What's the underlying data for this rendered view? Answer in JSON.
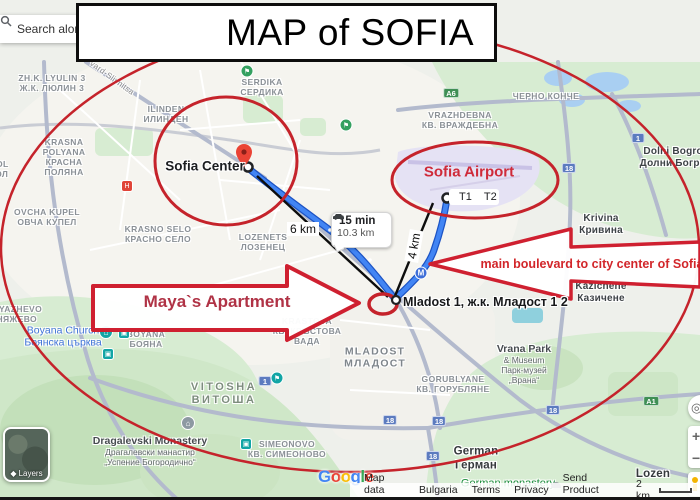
{
  "title": {
    "text": "MAP of SOFIA"
  },
  "search": {
    "placeholder": "Search along"
  },
  "annotations": {
    "center_label": "Sofia Center",
    "airport_label": "Sofia Airport",
    "terminal1": "T1",
    "terminal2": "T2",
    "route_time": "15 min",
    "route_distance": "10.3 km",
    "dist_center_line": "6 km",
    "dist_airport_line": "4 km",
    "apartment_arrow_text": "Maya`s Apartment",
    "boulevard_arrow_text": "main boulevard to city center of Sofia",
    "mladost_marker_label": "Mladost 1, ж.к. Младост 1 2",
    "metro_icon_glyph": "M"
  },
  "colors": {
    "annotation_red": "#c5232b",
    "arrow_stroke_red": "#cf2030",
    "maya_text_red": "#b03346",
    "boulevard_text_red": "#d2262a",
    "route_blue": "#4285f4",
    "route_blue_dark": "#1c53c4",
    "google": [
      "#4285F4",
      "#EA4335",
      "#FBBC05",
      "#4285F4",
      "#34A853",
      "#EA4335"
    ]
  },
  "map_labels": [
    {
      "name": "lyulin",
      "cls": "district",
      "x": 52,
      "y": 83,
      "lines": [
        "ZH.K. LYULIN 3",
        "Ж.К. ЛЮЛИН 3"
      ]
    },
    {
      "name": "slivnitsa-road",
      "cls": "road",
      "x": 112,
      "y": 78,
      "rotate": 36,
      "lines": [
        "vard-Slivnitsa"
      ]
    },
    {
      "name": "serdika",
      "cls": "district",
      "x": 262,
      "y": 87,
      "lines": [
        "SERDIKA",
        "СЕРДИКА"
      ]
    },
    {
      "name": "ilinden",
      "cls": "district",
      "x": 166,
      "y": 114,
      "lines": [
        "ILINDEN",
        "ИЛИНДЕН"
      ]
    },
    {
      "name": "cherno-konche",
      "cls": "district",
      "x": 546,
      "y": 96,
      "lines": [
        "ЧЕРНО КОНЧЕ"
      ]
    },
    {
      "name": "vrazhdebna",
      "cls": "district",
      "x": 460,
      "y": 120,
      "lines": [
        "VRAZHDEBNA",
        "КВ. ВРАЖДЕБНА"
      ]
    },
    {
      "name": "dolni-bogrov",
      "cls": "town",
      "x": 676,
      "y": 158,
      "lines": [
        "Dolni Bogrov",
        "Долни Богров"
      ]
    },
    {
      "name": "krivina",
      "cls": "town",
      "x": 601,
      "y": 225,
      "lines": [
        "Krivina",
        "Кривина"
      ]
    },
    {
      "name": "kazichene",
      "cls": "town",
      "x": 601,
      "y": 293,
      "lines": [
        "Kazichene",
        "Казичене"
      ]
    },
    {
      "name": "suhodol",
      "cls": "district",
      "x": -14,
      "y": 169,
      "lines": [
        "SUHODOL",
        "СУХОДОЛ"
      ]
    },
    {
      "name": "krasna-polyana",
      "cls": "district",
      "x": 64,
      "y": 157,
      "lines": [
        "KRASNA",
        "POLYANA",
        "КРАСНА",
        "ПОЛЯНА"
      ]
    },
    {
      "name": "ovcha-kupel",
      "cls": "district",
      "x": 47,
      "y": 217,
      "lines": [
        "OVCHA KUPEL",
        "ОВЧА КУПЕЛ"
      ]
    },
    {
      "name": "krasno-selo",
      "cls": "district",
      "x": 158,
      "y": 234,
      "lines": [
        "KRASNO SELO",
        "КРАСНО СЕЛО"
      ]
    },
    {
      "name": "lozenets",
      "cls": "district",
      "x": 263,
      "y": 242,
      "lines": [
        "LOZENETS",
        "ЛОЗЕНЕЦ"
      ]
    },
    {
      "name": "krastova-vada",
      "cls": "district",
      "x": 307,
      "y": 331,
      "lines": [
        "KRASTOVA",
        "КВ. КРЪСТОВА",
        "ВАДА"
      ]
    },
    {
      "name": "boyana-church",
      "cls": "poi-blue",
      "x": 63,
      "y": 337,
      "lines": [
        "Boyana Church",
        "Боянска църква"
      ]
    },
    {
      "name": "boyana",
      "cls": "district",
      "x": 146,
      "y": 339,
      "lines": [
        "BOYANA",
        "БОЯНА"
      ]
    },
    {
      "name": "knyazhevo",
      "cls": "district",
      "x": 14,
      "y": 314,
      "lines": [
        "KNYAZHEVO",
        "КНЯЖЕВО"
      ]
    },
    {
      "name": "vitosha",
      "cls": "mountain",
      "x": 224,
      "y": 394,
      "lines": [
        "VITOSHA",
        "ВИТОША"
      ]
    },
    {
      "name": "dragalevski-monastery",
      "cls": "poi-dark",
      "x": 150,
      "y": 451,
      "lines": [
        "Dragalevski Monastery",
        "Драгалевски манастир",
        "„Успение Богородично“"
      ]
    },
    {
      "name": "simeonovo",
      "cls": "district",
      "x": 287,
      "y": 449,
      "lines": [
        "SIMEONOVO",
        "КВ. СИМЕОНОВО"
      ]
    },
    {
      "name": "mladost",
      "cls": "district-lg",
      "x": 375,
      "y": 358,
      "lines": [
        "MLADOST",
        "МЛАДОСТ"
      ]
    },
    {
      "name": "gorublyane",
      "cls": "district",
      "x": 453,
      "y": 384,
      "lines": [
        "GORUBLYANE",
        "КВ. ГОРУБЛЯНЕ"
      ]
    },
    {
      "name": "vrana-park",
      "cls": "poi-dark",
      "x": 524,
      "y": 364,
      "lines": [
        "Vrana Park",
        "& Museum",
        "Парк-музей",
        "„Врана“"
      ]
    },
    {
      "name": "german",
      "cls": "town-lg",
      "x": 476,
      "y": 459,
      "lines": [
        "German",
        "Герман"
      ]
    },
    {
      "name": "german-monastery",
      "cls": "poi-green",
      "x": 508,
      "y": 484,
      "lines": [
        "German monastery"
      ]
    },
    {
      "name": "lozen",
      "cls": "town-lg",
      "x": 653,
      "y": 475,
      "lines": [
        "Lozen"
      ]
    }
  ],
  "road_shields": [
    {
      "label": "A6",
      "kind": "g",
      "x": 451,
      "y": 93
    },
    {
      "label": "1",
      "kind": "b",
      "x": 638,
      "y": 138
    },
    {
      "label": "18",
      "kind": "b",
      "x": 569,
      "y": 168
    },
    {
      "label": "1",
      "kind": "b",
      "x": 265,
      "y": 381
    },
    {
      "label": "18",
      "kind": "b",
      "x": 390,
      "y": 420
    },
    {
      "label": "18",
      "kind": "b",
      "x": 439,
      "y": 421
    },
    {
      "label": "18",
      "kind": "b",
      "x": 553,
      "y": 410
    },
    {
      "label": "A1",
      "kind": "g",
      "x": 651,
      "y": 401
    },
    {
      "label": "18",
      "kind": "b",
      "x": 433,
      "y": 456
    }
  ],
  "poi_icons": [
    {
      "name": "park-poi-icon",
      "shape": "circle",
      "color": "#34a060",
      "glyph": "⚑",
      "x": 247,
      "y": 71
    },
    {
      "name": "park-poi-icon",
      "shape": "circle",
      "color": "#34a060",
      "glyph": "⚑",
      "x": 346,
      "y": 125
    },
    {
      "name": "hospital-icon",
      "shape": "square",
      "color": "#e04438",
      "glyph": "H",
      "x": 127,
      "y": 186
    },
    {
      "name": "church-pin-icon",
      "shape": "pin",
      "color": "#12a5a5",
      "glyph": "⌂",
      "x": 106,
      "y": 332
    },
    {
      "name": "museum-poi-icon",
      "shape": "square",
      "color": "#12a5a5",
      "glyph": "▣",
      "x": 124,
      "y": 333
    },
    {
      "name": "museum-poi-icon",
      "shape": "square",
      "color": "#12a5a5",
      "glyph": "▣",
      "x": 108,
      "y": 354
    },
    {
      "name": "monastery-pin-icon",
      "shape": "pin",
      "color": "#8d99a2",
      "glyph": "⌂",
      "x": 188,
      "y": 423
    },
    {
      "name": "museum-poi-icon",
      "shape": "square",
      "color": "#12a5a5",
      "glyph": "▣",
      "x": 246,
      "y": 444
    },
    {
      "name": "park-poi-icon",
      "shape": "circle",
      "color": "#12a5a5",
      "glyph": "⚑",
      "x": 277,
      "y": 378
    },
    {
      "name": "monastery-dome-icon",
      "shape": "dome",
      "color": "#9aa0a6",
      "glyph": "",
      "x": 556,
      "y": 485
    }
  ],
  "controls": {
    "layers_label": "Layers",
    "zoom_in": "+",
    "zoom_out": "−",
    "my_location_glyph": "◎"
  },
  "footer": {
    "logo": "Google",
    "map_data": "Map data ©2024",
    "links": [
      "Bulgaria",
      "Terms",
      "Privacy",
      "Send Product Feedback"
    ],
    "scale_label": "2 km"
  }
}
